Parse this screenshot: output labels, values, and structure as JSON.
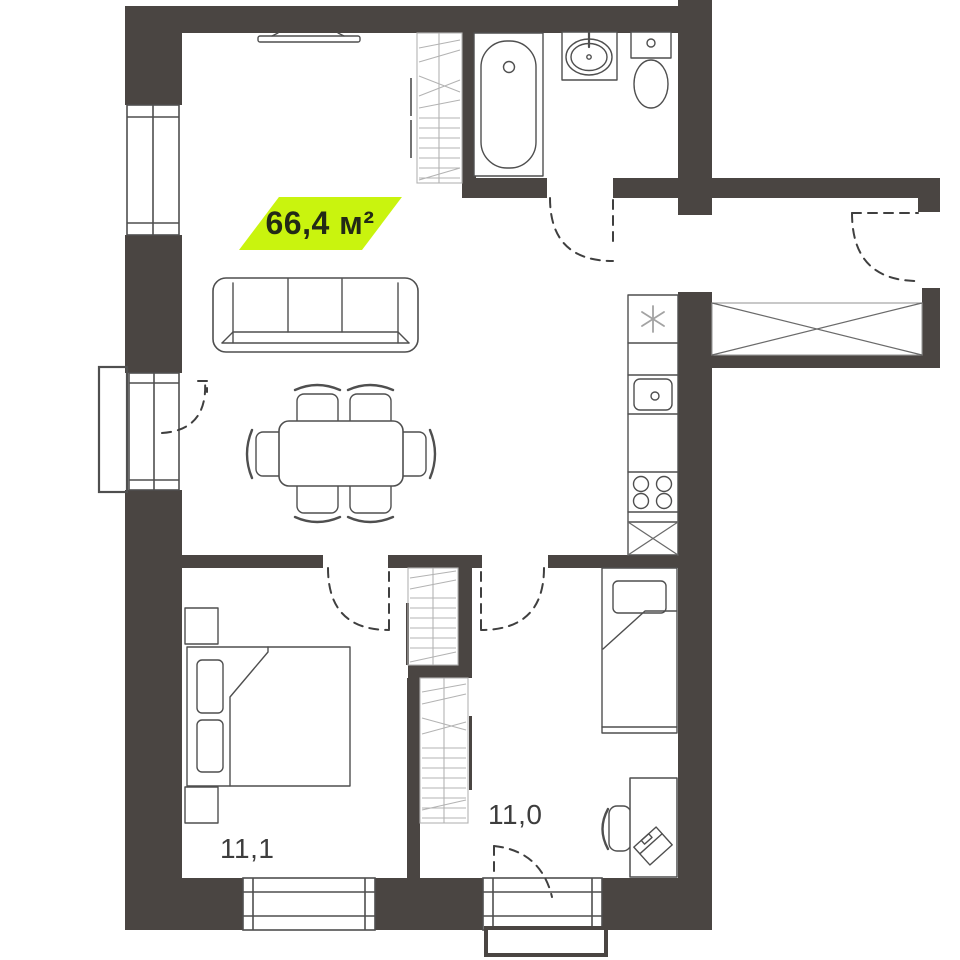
{
  "floor_plan": {
    "area_badge": {
      "label": "66,4 м²",
      "bg_color": "#c9f40e",
      "text_color": "#222a16"
    },
    "room_labels": [
      {
        "room": "bedroom-left",
        "label": "11,1"
      },
      {
        "room": "bedroom-right",
        "label": "11,0"
      }
    ],
    "colors": {
      "walls": "#4a4542",
      "outlines": "#4f4f4f",
      "hatch": "#b3b3b3",
      "door_dash": "#3f3f3f",
      "background": "#ffffff"
    }
  }
}
